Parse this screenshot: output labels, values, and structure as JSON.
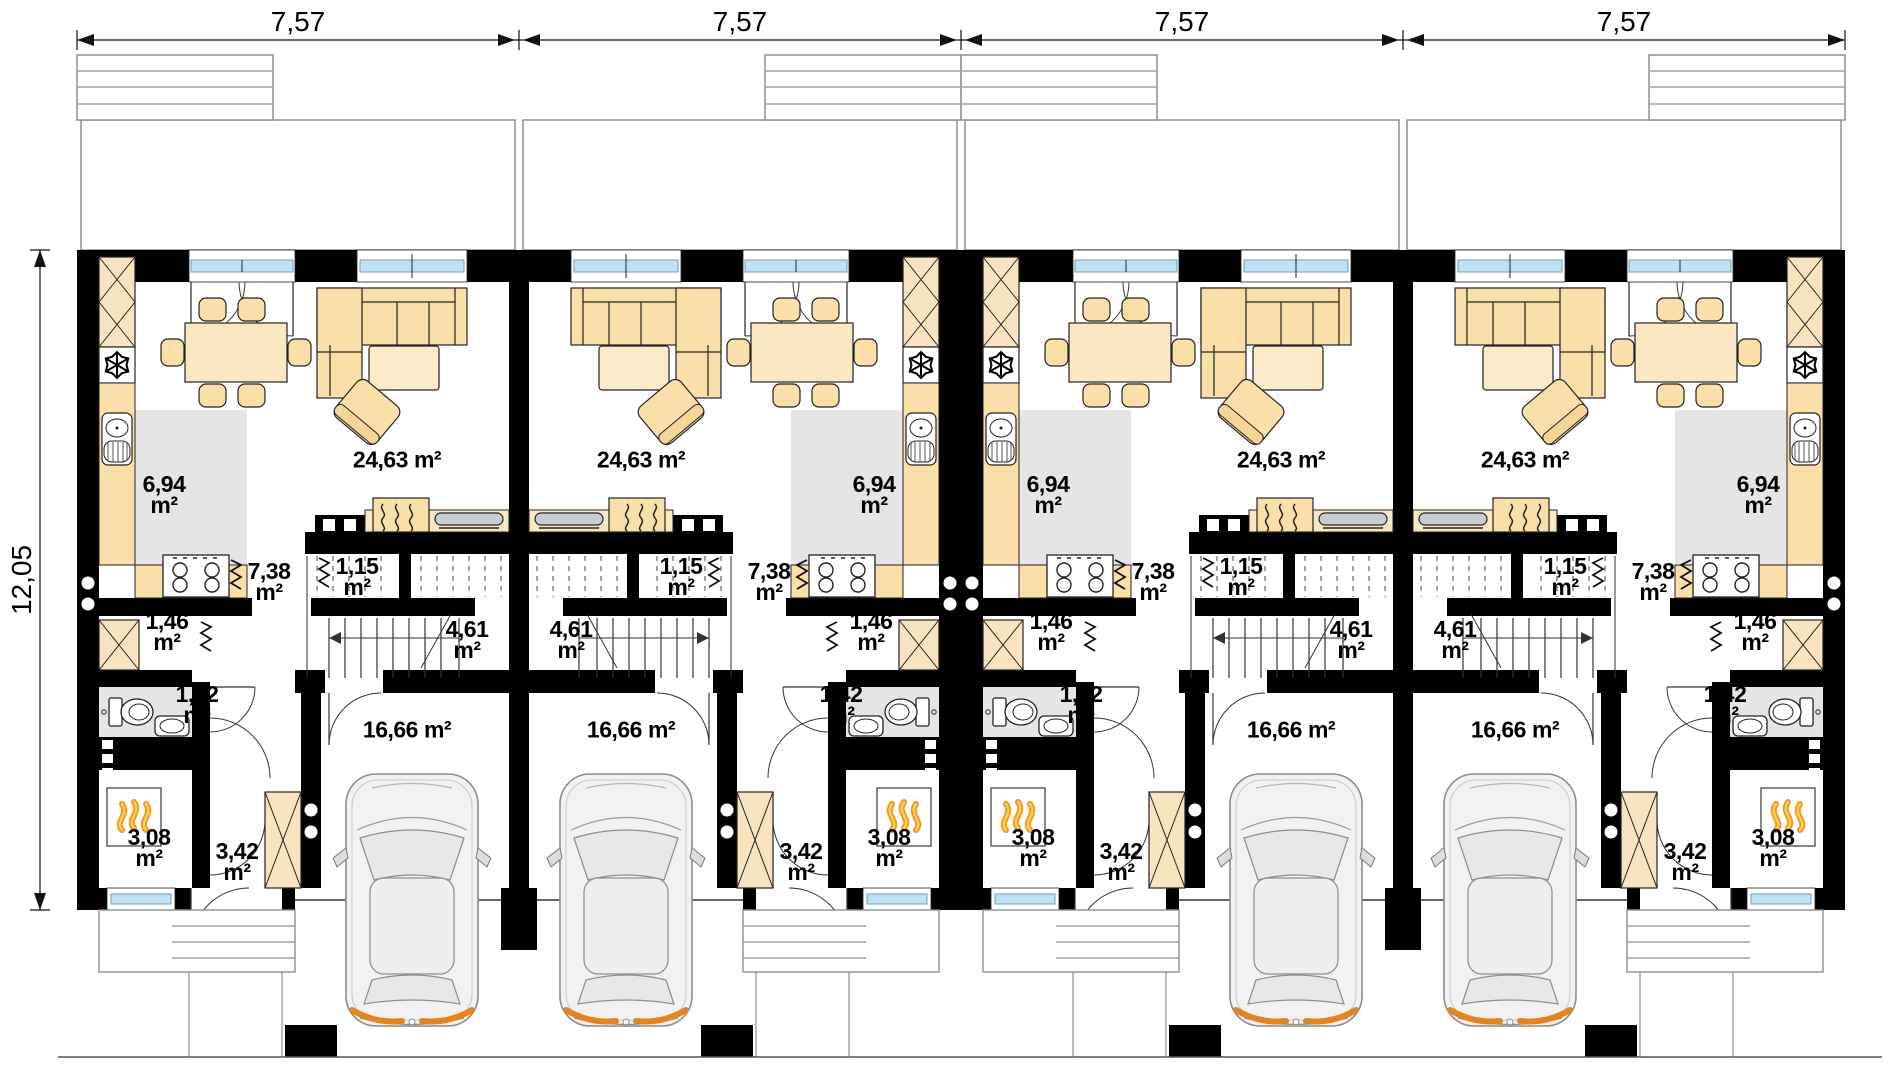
{
  "dimensions": {
    "unit_widths": [
      "7,57",
      "7,57",
      "7,57",
      "7,57"
    ],
    "total_depth": "12,05"
  },
  "area_unit": "m²",
  "units": [
    {
      "name": "unit-1",
      "mirrored": false,
      "rooms": {
        "living_dining": {
          "value": "24,63",
          "unit": "m²"
        },
        "kitchen": {
          "value": "6,94",
          "unit": "m²"
        },
        "hall": {
          "value": "7,38",
          "unit": "m²"
        },
        "wc": {
          "value": "1,15",
          "unit": "m²"
        },
        "stairs": {
          "value": "4,61",
          "unit": "m²"
        },
        "pantry": {
          "value": "1,46",
          "unit": "m²"
        },
        "bathroom": {
          "value": "1,42",
          "unit": "m²"
        },
        "garage": {
          "value": "16,66",
          "unit": "m²"
        },
        "boiler_room": {
          "value": "3,08",
          "unit": "m²"
        },
        "entry": {
          "value": "3,42",
          "unit": "m²"
        }
      }
    },
    {
      "name": "unit-2",
      "mirrored": true,
      "rooms": {
        "living_dining": {
          "value": "24,63",
          "unit": "m²"
        },
        "kitchen": {
          "value": "6,94",
          "unit": "m²"
        },
        "hall": {
          "value": "7,38",
          "unit": "m²"
        },
        "wc": {
          "value": "1,15",
          "unit": "m²"
        },
        "stairs": {
          "value": "4,61",
          "unit": "m²"
        },
        "pantry": {
          "value": "1,46",
          "unit": "m²"
        },
        "bathroom": {
          "value": "1,42",
          "unit": "m²"
        },
        "garage": {
          "value": "16,66",
          "unit": "m²"
        },
        "boiler_room": {
          "value": "3,08",
          "unit": "m²"
        },
        "entry": {
          "value": "3,42",
          "unit": "m²"
        }
      }
    },
    {
      "name": "unit-3",
      "mirrored": false,
      "rooms": {
        "living_dining": {
          "value": "24,63",
          "unit": "m²"
        },
        "kitchen": {
          "value": "6,94",
          "unit": "m²"
        },
        "hall": {
          "value": "7,38",
          "unit": "m²"
        },
        "wc": {
          "value": "1,15",
          "unit": "m²"
        },
        "stairs": {
          "value": "4,61",
          "unit": "m²"
        },
        "pantry": {
          "value": "1,46",
          "unit": "m²"
        },
        "bathroom": {
          "value": "1,42",
          "unit": "m²"
        },
        "garage": {
          "value": "16,66",
          "unit": "m²"
        },
        "boiler_room": {
          "value": "3,08",
          "unit": "m²"
        },
        "entry": {
          "value": "3,42",
          "unit": "m²"
        }
      }
    },
    {
      "name": "unit-4",
      "mirrored": true,
      "rooms": {
        "living_dining": {
          "value": "24,63",
          "unit": "m²"
        },
        "kitchen": {
          "value": "6,94",
          "unit": "m²"
        },
        "hall": {
          "value": "7,38",
          "unit": "m²"
        },
        "wc": {
          "value": "1,15",
          "unit": "m²"
        },
        "stairs": {
          "value": "4,61",
          "unit": "m²"
        },
        "pantry": {
          "value": "1,46",
          "unit": "m²"
        },
        "bathroom": {
          "value": "1,42",
          "unit": "m²"
        },
        "garage": {
          "value": "16,66",
          "unit": "m²"
        },
        "boiler_room": {
          "value": "3,08",
          "unit": "m²"
        },
        "entry": {
          "value": "3,42",
          "unit": "m²"
        }
      }
    }
  ],
  "colors": {
    "wall": "#000000",
    "furniture_beige": "#FADFA9",
    "furniture_light": "#FBEBCB",
    "floor_gray": "#E5E5E5",
    "window_glass": "#BEE3F6",
    "flame_orange": "#F7941D",
    "flame_yellow": "#FFD34D",
    "taillight_orange": "#E8821B"
  }
}
